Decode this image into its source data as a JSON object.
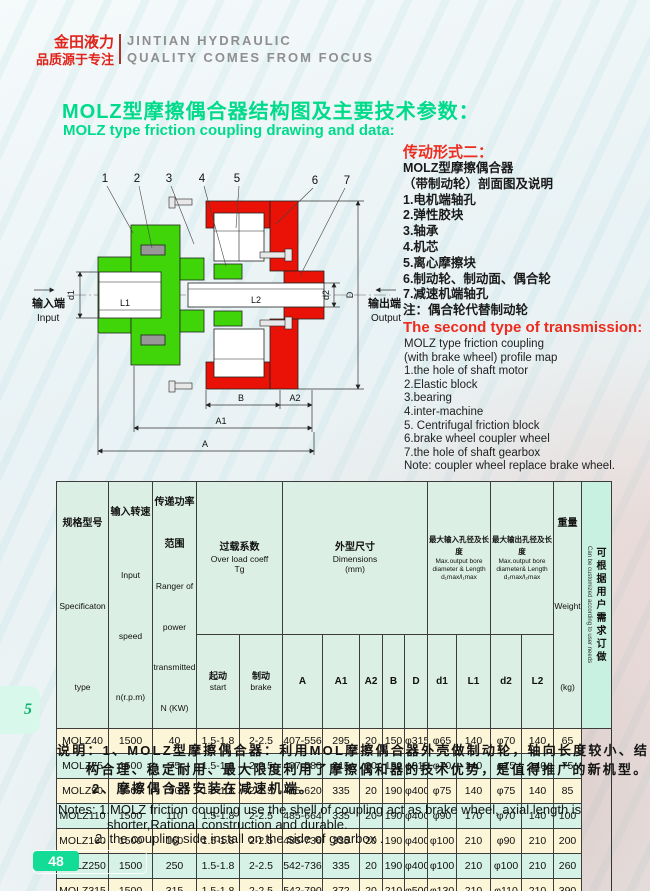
{
  "header": {
    "brand_cn_1": "金田液力",
    "brand_cn_2": "品质源于专注",
    "brand_en_1": "JINTIAN HYDRAULIC",
    "brand_en_2": "QUALITY COMES FROM FOCUS"
  },
  "title": {
    "cn": "MOLZ型摩擦偶合器结构图及主要技术参数：",
    "en": "MOLZ type friction coupling drawing and data:"
  },
  "drawing": {
    "callouts": [
      "1",
      "2",
      "3",
      "4",
      "5",
      "6",
      "7"
    ],
    "labels": {
      "l1": "L1",
      "l2": "L2",
      "d1": "d1",
      "d2": "d2",
      "dd": "D",
      "b": "B",
      "a2": "A2",
      "a1": "A1",
      "a": "A",
      "input_cn": "输入端",
      "input_en": "Input",
      "output_cn": "输出端",
      "output_en": "Output"
    },
    "colors": {
      "green": "#3fd508",
      "red": "#ea1207"
    }
  },
  "transmission_cn": {
    "heading": "传动形式二：",
    "lines": [
      "MOLZ型摩擦偶合器",
      "（带制动轮）剖面图及说明",
      "1.电机端轴孔",
      "2.弹性胶块",
      "3.轴承",
      "4.机芯",
      "5.离心摩擦块",
      "6.制动轮、制动面、偶合轮",
      "7.减速机端轴孔",
      "注：偶合轮代替制动轮"
    ]
  },
  "transmission_en": {
    "heading": "The second type of transmission:",
    "lines": [
      "MOLZ type friction coupling",
      "(with brake wheel) profile map",
      "1.the hole of shaft motor",
      "2.Elastic block",
      "3.bearing",
      "4.inter-machine",
      "5. Centrifugal friction block",
      "6.brake wheel  coupler wheel",
      "7.the hole of shaft gearbox",
      "Note: coupler wheel replace brake wheel."
    ]
  },
  "table": {
    "header": {
      "spec": {
        "cn": "规格型号",
        "en": "Specificaton",
        "sub": "type"
      },
      "speed": {
        "cn": "输入转速",
        "en1": "Input",
        "en2": "speed",
        "sub": "n(r.p.m)"
      },
      "power": {
        "cn1": "传递功率",
        "cn2": "范围",
        "en1": "Ranger of",
        "en2": "power",
        "en3": "transmitted",
        "sub": "N (KW)"
      },
      "overload": {
        "cn": "过载系数",
        "en": "Over load coeff",
        "tg": "Tg",
        "start_cn": "起动",
        "start_en": "start",
        "brake_cn": "制动",
        "brake_en": "brake"
      },
      "dims": {
        "cn": "外型尺寸",
        "en": "Dimensions",
        "unit": "(mm)",
        "c1": "A",
        "c2": "A1",
        "c3": "A2",
        "c4": "B",
        "c5": "D"
      },
      "in_bore": {
        "cn": "最大输入孔径及长度",
        "en1": "Max.output bore",
        "en2": "diameter & Length",
        "en3": "d₁max/l₁max",
        "c1": "d1",
        "c2": "L1"
      },
      "out_bore": {
        "cn": "最大输出孔径及长度",
        "en1": "Max.output bore",
        "en2": "diameter& Length",
        "en3": "d₂max/l₂max",
        "c1": "d2",
        "c2": "L2"
      },
      "weight": {
        "cn": "重量",
        "en": "Weight",
        "unit": "(kg)"
      },
      "custom": {
        "cn": "可根据用户需求订做",
        "en": "Can be customized according to user needs"
      }
    },
    "rows": [
      {
        "cells": [
          "MOLZ40",
          "1500",
          "40",
          "1.5-1.8",
          "2-2.5",
          "407-556",
          "295",
          "20",
          "150",
          "φ315",
          "φ65",
          "140",
          "φ70",
          "140",
          "65"
        ]
      },
      {
        "cells": [
          "MOLZ75",
          "1500",
          "75",
          "1.5-1.8",
          "2-2.5",
          "407-580",
          "315",
          "20",
          "150",
          "φ315",
          "φ70",
          "140",
          "φ75",
          "140",
          "75"
        ]
      },
      {
        "cells": [
          "MOLZ90",
          "1500",
          "90",
          "1.5-1.8",
          "2-2.5",
          "485-620",
          "335",
          "20",
          "190",
          "φ400",
          "φ75",
          "140",
          "φ75",
          "140",
          "85"
        ]
      },
      {
        "cells": [
          "MOLZ110",
          "1500",
          "110",
          "1.5-1.8",
          "2-2.5",
          "485-664",
          "335",
          "20",
          "190",
          "φ400",
          "φ90",
          "170",
          "φ70",
          "140",
          "100"
        ]
      },
      {
        "cells": [
          "MOLZ160",
          "1500",
          "160",
          "1.5-1.8",
          "2-2.5",
          "485-736",
          "335",
          "20",
          "190",
          "φ400",
          "φ100",
          "210",
          "φ90",
          "210",
          "200"
        ]
      },
      {
        "cells": [
          "MOLZ250",
          "1500",
          "250",
          "1.5-1.8",
          "2-2.5",
          "542-736",
          "335",
          "20",
          "190",
          "φ400",
          "φ100",
          "210",
          "φ100",
          "210",
          "260"
        ]
      },
      {
        "cells": [
          "MOLZ315",
          "1500",
          "315",
          "1.5-1.8",
          "2-2.5",
          "542-790",
          "372",
          "20",
          "210",
          "φ500",
          "φ130",
          "210",
          "φ110",
          "210",
          "390"
        ]
      }
    ]
  },
  "notes_cn": {
    "line1": "说明：1、MOLZ型摩擦偶合器：利用MOL摩擦偶合器外壳做制动轮，轴向长度较小、结",
    "line2": "构合理、稳定耐用、最大限度利用了摩擦偶和器的技术优势，是值得推广的新机型。",
    "line3": "2、摩擦偶合器安装在减速机端。"
  },
  "notes_en": {
    "line1": "Notes: 1.MOLZ friction coupling use the shell of coupling act as brake wheel, axial length is",
    "line2": "shorter,Rational construction and durable.",
    "line3": "2. the coupling side install on the side of gearbox ."
  },
  "footer": {
    "side_tab": "5",
    "page_number": "48"
  }
}
